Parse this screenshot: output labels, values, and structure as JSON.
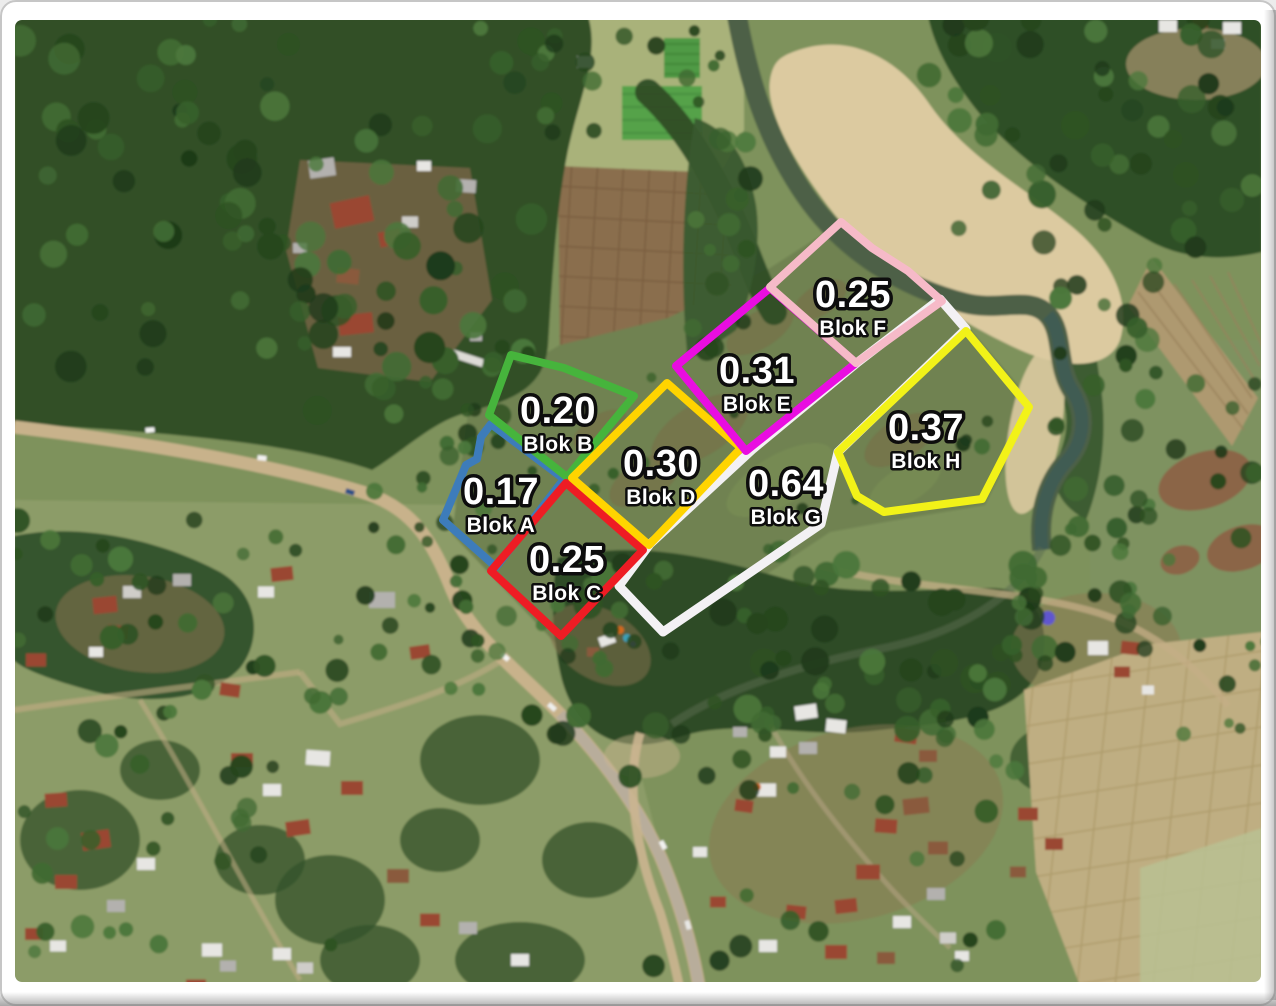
{
  "image": {
    "kind": "annotated-satellite-parcel-map",
    "frame_color": "#ffffff",
    "frame_edge_color": "#c6c6c6"
  },
  "blocks": [
    {
      "id": "blok-a",
      "name": "Blok A",
      "area": "0.17",
      "outline_color": "#3d7cba",
      "polygon": "491,424 564,479 496,567 443,520 466,465 477,459 481,437",
      "label_x": 501,
      "label_y": 490
    },
    {
      "id": "blok-b",
      "name": "Blok B",
      "area": "0.20",
      "outline_color": "#46b43c",
      "polygon": "511,355 564,368 634,396 567,477 489,415",
      "label_x": 558,
      "label_y": 409
    },
    {
      "id": "blok-c",
      "name": "Blok C",
      "area": "0.25",
      "outline_color": "#ee1c24",
      "polygon": "566,483 643,550 561,636 491,571",
      "label_x": 567,
      "label_y": 558
    },
    {
      "id": "blok-d",
      "name": "Blok D",
      "area": "0.30",
      "outline_color": "#ffd400",
      "polygon": "667,383 741,448 649,545 572,478",
      "label_x": 661,
      "label_y": 462
    },
    {
      "id": "blok-e",
      "name": "Blok E",
      "area": "0.31",
      "outline_color": "#e90de1",
      "polygon": "770,288 856,363 746,451 676,366",
      "label_x": 757,
      "label_y": 369
    },
    {
      "id": "blok-f",
      "name": "Blok F",
      "area": "0.25",
      "outline_color": "#f6bac8",
      "polygon": "770,287 841,222 872,248 908,271 942,301 856,363",
      "label_x": 853,
      "label_y": 293
    },
    {
      "id": "blok-g",
      "name": "Blok G",
      "area": "0.64",
      "outline_color": "#f3f1f4",
      "polygon": "940,299 966,329 838,452 821,524 663,632 619,586 650,544 753,449 858,362",
      "label_x": 786,
      "label_y": 482
    },
    {
      "id": "blok-h",
      "name": "Blok H",
      "area": "0.37",
      "outline_color": "#f2f218",
      "polygon": "838,452 966,331 1029,407 982,499 884,512 857,496",
      "label_x": 926,
      "label_y": 426
    }
  ]
}
